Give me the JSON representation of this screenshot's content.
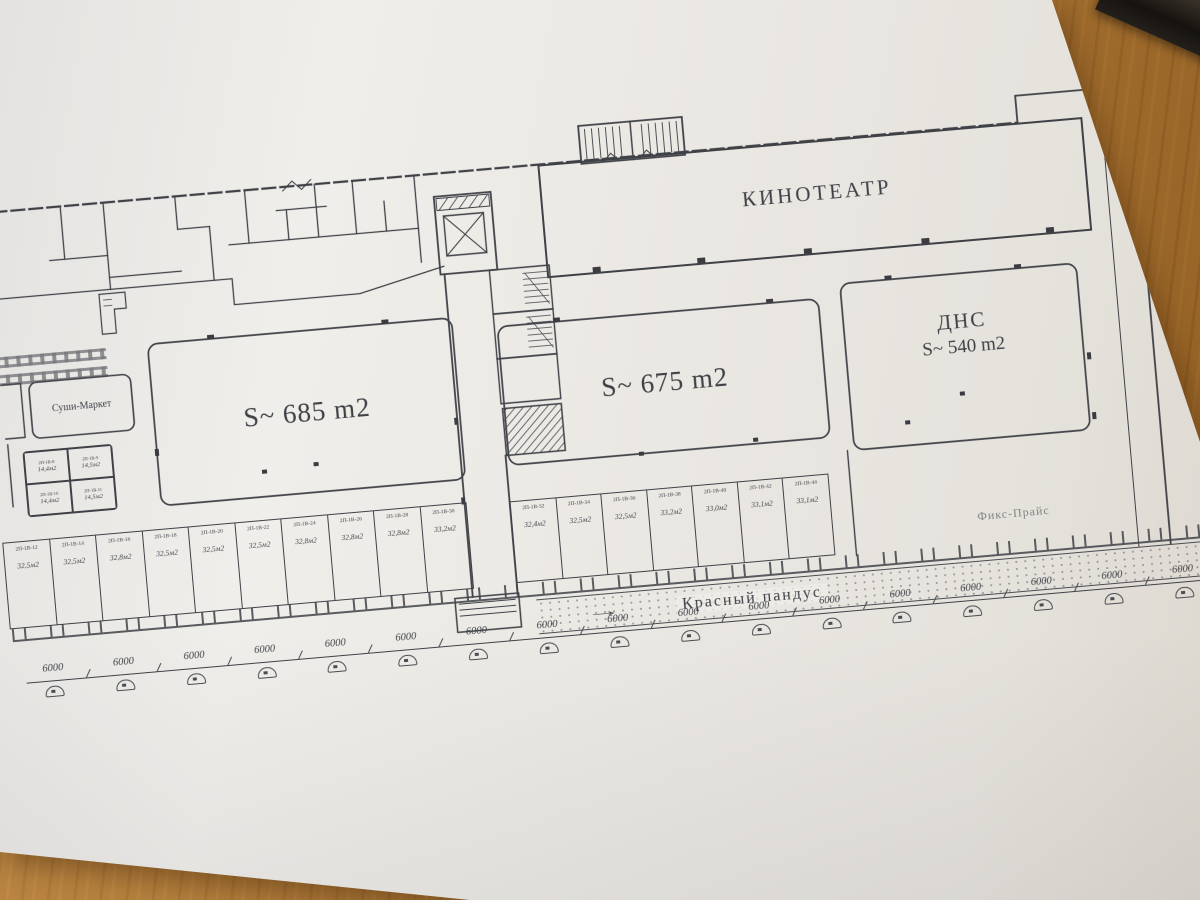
{
  "colors": {
    "ink": "#3f4147",
    "paper": "#f0eeea",
    "wood": "#b1762e"
  },
  "plan": {
    "cinema_label": "КИНОТЕАТР",
    "unit_685": "S~ 685 m2",
    "unit_675": "S~ 675 m2",
    "dns_name": "ДНС",
    "dns_area": "S~ 540 m2",
    "sushi_label": "Суши-Маркет",
    "fixprice_label": "Фикс-Прайс",
    "ramp_label": "Красный пандус",
    "ramp_arrow": "→",
    "small_rooms": [
      {
        "code": "2П-1В-8",
        "area": "14,4м2"
      },
      {
        "code": "2П-1В-9",
        "area": "14,5м2"
      },
      {
        "code": "2П-1В-10",
        "area": "14,4м2"
      },
      {
        "code": "2П-1В-11",
        "area": "14,5м2"
      }
    ],
    "shops_bottom": [
      {
        "code": "2П-1В-12",
        "area": "32,5м2"
      },
      {
        "code": "2П-1В-14",
        "area": "32,5м2"
      },
      {
        "code": "2П-1В-16",
        "area": "32,8м2"
      },
      {
        "code": "2П-1В-18",
        "area": "32,5м2"
      },
      {
        "code": "2П-1В-20",
        "area": "32,5м2"
      },
      {
        "code": "2П-1В-22",
        "area": "32,5м2"
      },
      {
        "code": "2П-1В-24",
        "area": "32,8м2"
      },
      {
        "code": "2П-1В-26",
        "area": "32,8м2"
      },
      {
        "code": "2П-1В-28",
        "area": "32,8м2"
      },
      {
        "code": "2П-1В-30",
        "area": "33,2м2"
      }
    ],
    "shops_middle": [
      {
        "code": "2П-1В-32",
        "area": "32,4м2"
      },
      {
        "code": "2П-1В-34",
        "area": "32,5м2"
      },
      {
        "code": "2П-1В-36",
        "area": "32,5м2"
      },
      {
        "code": "2П-1В-38",
        "area": "33,2м2"
      },
      {
        "code": "2П-1В-40",
        "area": "33,0м2"
      },
      {
        "code": "2П-1В-42",
        "area": "33,1м2"
      },
      {
        "code": "2П-1В-44",
        "area": "33,1м2"
      }
    ],
    "dim_labels": [
      "6000",
      "6000",
      "6000",
      "6000",
      "6000",
      "6000",
      "6000",
      "6000",
      "6000",
      "6000",
      "6000",
      "6000",
      "6000",
      "6000",
      "6000",
      "6000",
      "6000"
    ]
  }
}
